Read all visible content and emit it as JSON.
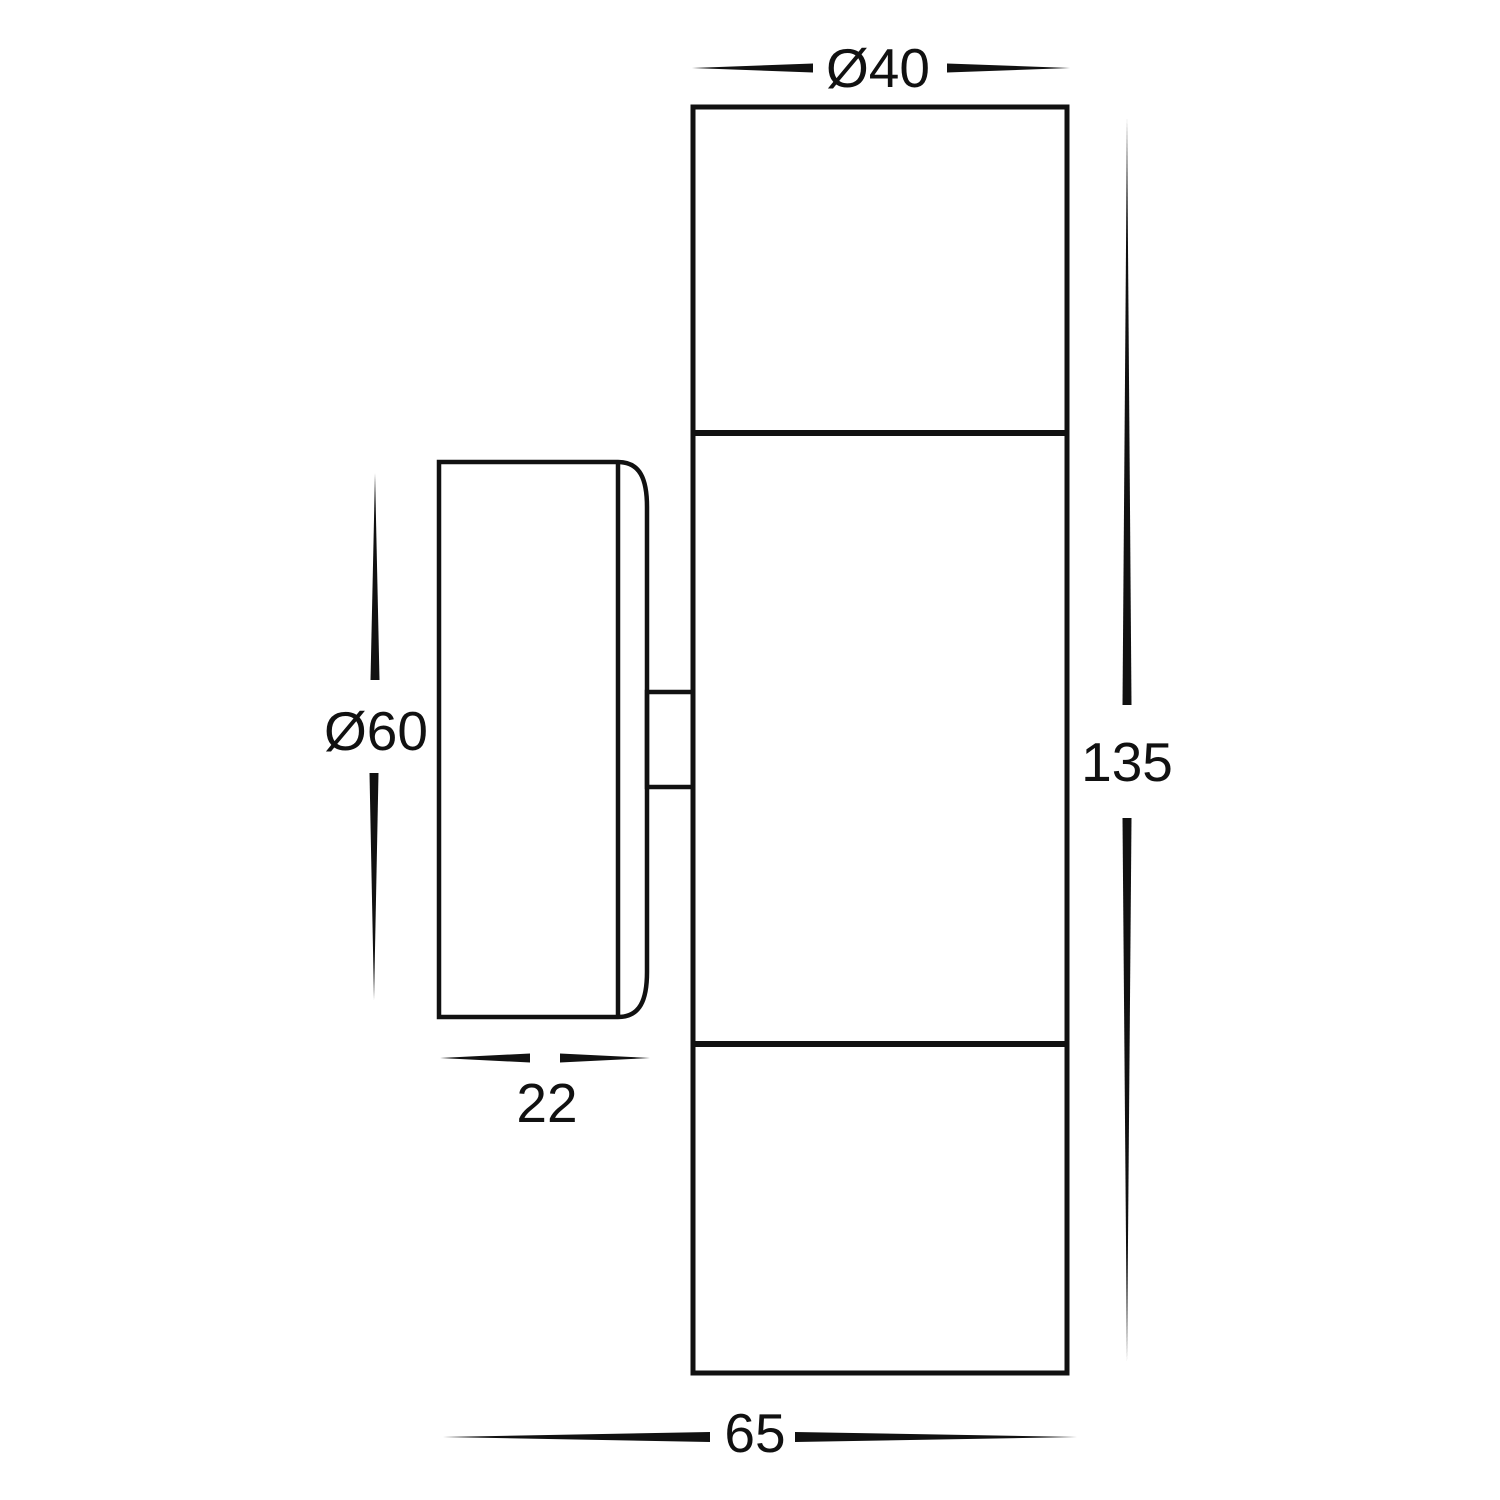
{
  "colors": {
    "background": "#ffffff",
    "line": "#111111"
  },
  "dimension_labels": {
    "body_diameter": "Ø40",
    "plate_diameter": "Ø60",
    "body_height": "135",
    "plate_depth": "22",
    "overall_depth": "65"
  }
}
